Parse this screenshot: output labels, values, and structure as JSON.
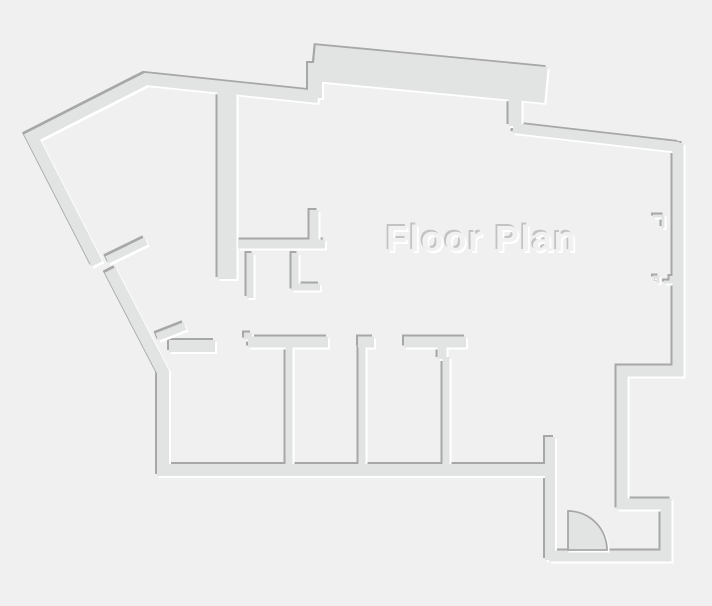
{
  "title": {
    "text": "Floor Plan"
  },
  "colors": {
    "background": "#f0f0f1",
    "wall_body": "#e2e4e4",
    "wall_shadow": "#a7a7a9",
    "wall_highlight": "#ffffff",
    "title_fill": "#f1f1f2",
    "title_shadow": "#c2c3c5",
    "title_highlight": "#ffffff",
    "door_fill": "#e2e4e4",
    "door_stroke": "#a7a7a9"
  },
  "floor_plan": {
    "emboss_offset": 2,
    "title_anchor": {
      "x": 386,
      "y": 251
    },
    "walls": [
      {
        "name": "outer-top-and-upper-diagonal",
        "d": "M318,97 L146,79 L32,137 L97,264",
        "w": 12
      },
      {
        "name": "outer-lower-diagonal-and-left",
        "d": "M110,270 L163,372 L163,476",
        "w": 12
      },
      {
        "name": "top-protrusion-band",
        "d": "M314,63 L546,85",
        "w": 36
      },
      {
        "name": "top-protrusion-left-leg",
        "d": "M315,63 L315,98",
        "w": 14
      },
      {
        "name": "top-protrusion-tab",
        "d": "M515,98 L515,126",
        "w": 13
      },
      {
        "name": "top-right-slanted-wall",
        "d": "M513,128 L679,147",
        "w": 10
      },
      {
        "name": "right-outer-chain",
        "d": "M678,143 L678,371 L622,371 L622,504 L666,504 L666,556 L549,556",
        "w": 11
      },
      {
        "name": "vestibule-left-wall",
        "d": "M550,437 L550,560",
        "w": 10
      },
      {
        "name": "bottom-rooms-wall",
        "d": "M158,470 L552,470",
        "w": 12
      },
      {
        "name": "upper-interior-thick-wall",
        "d": "M227,91 L227,279",
        "w": 19
      },
      {
        "name": "interior-l-wall-horizontal",
        "d": "M238,244 L325,244",
        "w": 9
      },
      {
        "name": "interior-l-wall-stub",
        "d": "M314,248 L314,210",
        "w": 9
      },
      {
        "name": "interior-stub-left",
        "d": "M250,253 L250,298",
        "w": 7
      },
      {
        "name": "interior-stub-l-shape",
        "d": "M295,253 L295,287 L320,287",
        "w": 7
      },
      {
        "name": "diagonal-door-jamb-upper",
        "d": "M107,260 L146,241",
        "w": 8
      },
      {
        "name": "diagonal-door-jamb-lower",
        "d": "M157,337 L185,326",
        "w": 8
      },
      {
        "name": "room1-top-wall",
        "d": "M169,346 L215,346",
        "w": 12
      },
      {
        "name": "room2-cap-step",
        "d": "M244,336 L252,336",
        "w": 7
      },
      {
        "name": "room2-top-cap",
        "d": "M248,342 L328,342",
        "w": 11
      },
      {
        "name": "partition1-stem",
        "d": "M289,347 L289,466",
        "w": 7
      },
      {
        "name": "partition2-cap",
        "d": "M358,342 L374,342",
        "w": 11
      },
      {
        "name": "partition2-stem",
        "d": "M362,346 L362,466",
        "w": 7
      },
      {
        "name": "partition3-cap",
        "d": "M404,342 L466,342",
        "w": 11
      },
      {
        "name": "partition3-offset-stub",
        "d": "M442,346 L442,359",
        "w": 9
      },
      {
        "name": "partition3-stem",
        "d": "M446,357 L446,466",
        "w": 7
      },
      {
        "name": "right-wall-opening-jamb-upper",
        "d": "M653,216 L663,216 L663,228",
        "w": 3
      },
      {
        "name": "right-wall-opening-jamb-lower-a",
        "d": "M653,277 L658,277 L658,283",
        "w": 3
      },
      {
        "name": "right-wall-opening-jamb-lower-b",
        "d": "M664,282 L671,282 L671,276",
        "w": 3
      }
    ],
    "door_arc": {
      "cx": 568,
      "cy": 550,
      "r": 39
    }
  }
}
